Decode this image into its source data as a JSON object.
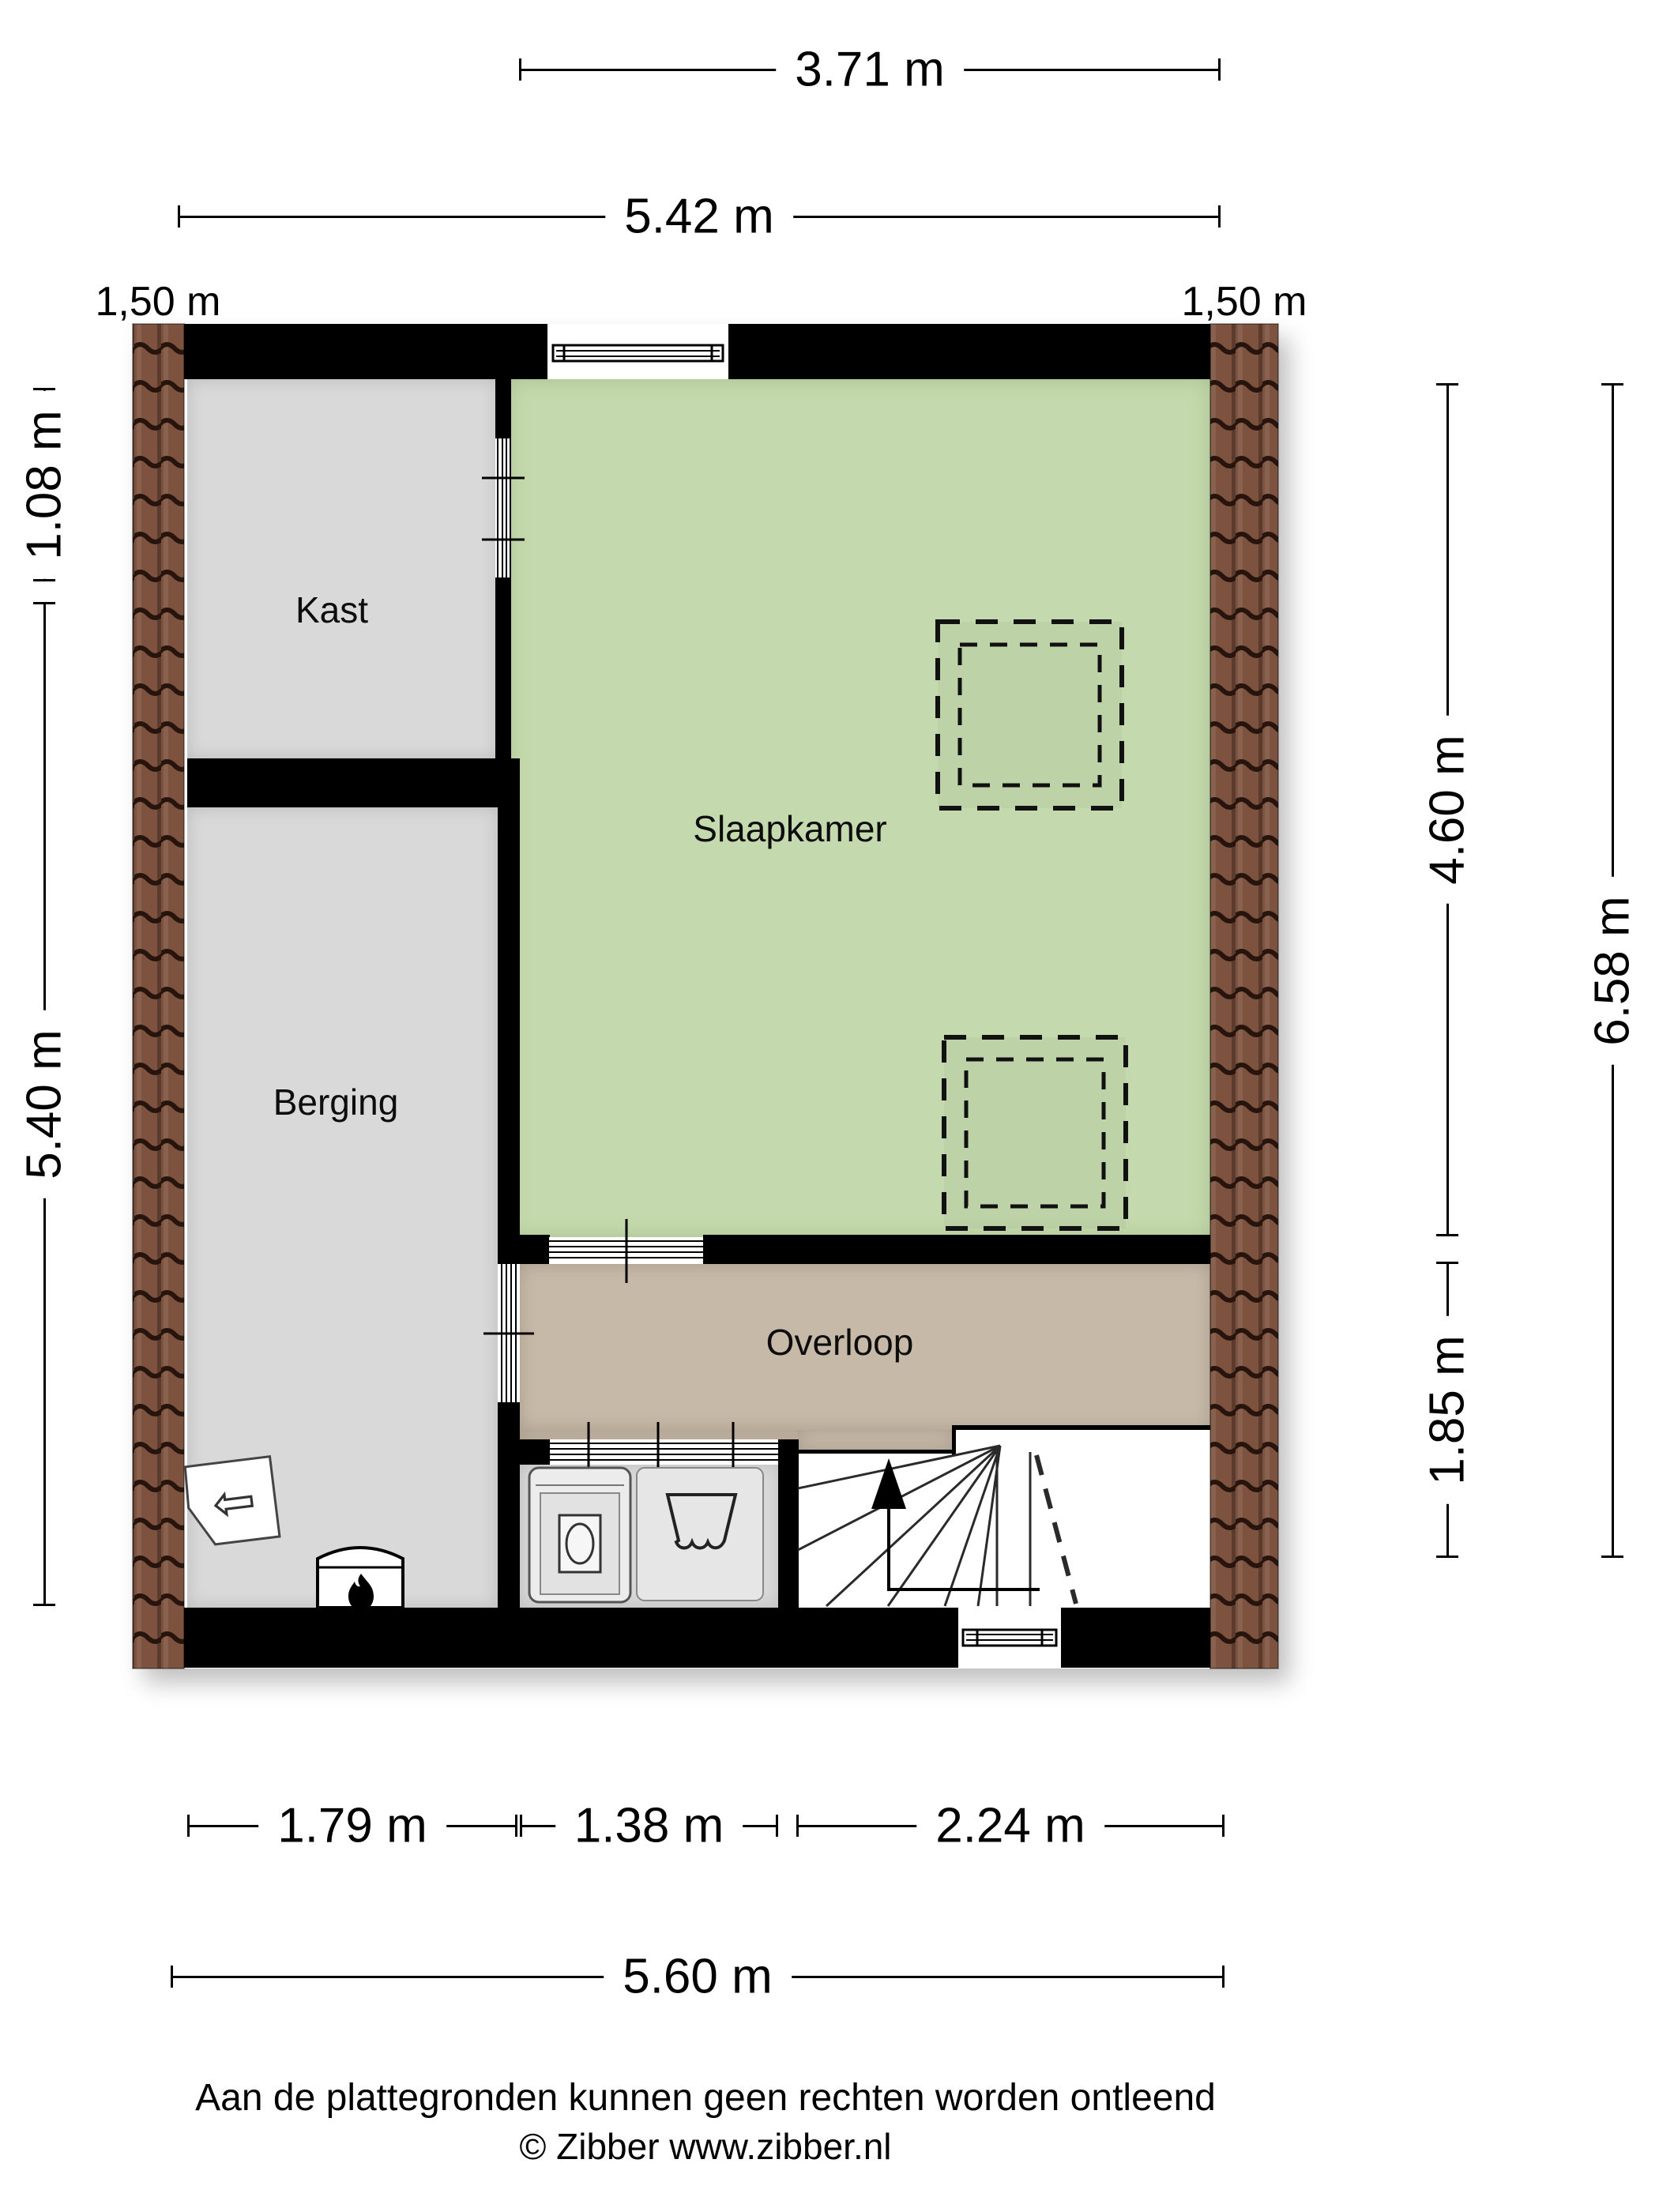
{
  "rooms": [
    {
      "id": "kast",
      "label": "Kast",
      "floor_color": "#d9d9d9"
    },
    {
      "id": "slaapkamer",
      "label": "Slaapkamer",
      "floor_color": "#c5d9ae"
    },
    {
      "id": "berging",
      "label": "Berging",
      "floor_color": "#d9d9d9"
    },
    {
      "id": "overloop",
      "label": "Overloop",
      "floor_color": "#c7b9a7"
    }
  ],
  "dims": {
    "top_width": "3.71 m",
    "upper_width": "5.42 m",
    "left_knee": "1,50 m",
    "right_knee": "1,50 m",
    "left_top": "1.08 m",
    "left_main": "5.40 m",
    "right_upper": "4.60 m",
    "right_lower": "1.85 m",
    "right_total": "6.58 m",
    "bottom_berging": "1.79 m",
    "bottom_laundry": "1.38 m",
    "bottom_stairs": "2.24 m",
    "bottom_total": "5.60 m"
  },
  "footer": {
    "disclaimer": "Aan de plattegronden kunnen geen rechten worden ontleend",
    "copyright": "© Zibber www.zibber.nl"
  },
  "colors": {
    "wall": "#000000",
    "bedroom_green": "#c5d9ae",
    "landing_tan": "#c7b9a7",
    "room_gray": "#d9d9d9",
    "roof_tile_brown": "#7d523e"
  },
  "icons": [
    {
      "name": "roof-tiles-left"
    },
    {
      "name": "roof-tiles-right"
    },
    {
      "name": "skylight-upper"
    },
    {
      "name": "skylight-lower"
    },
    {
      "name": "staircase-up-arrow"
    },
    {
      "name": "stove-flame-icon"
    },
    {
      "name": "escape-route-icon"
    },
    {
      "name": "washing-machine-icon"
    },
    {
      "name": "laundry-basket-icon"
    }
  ]
}
